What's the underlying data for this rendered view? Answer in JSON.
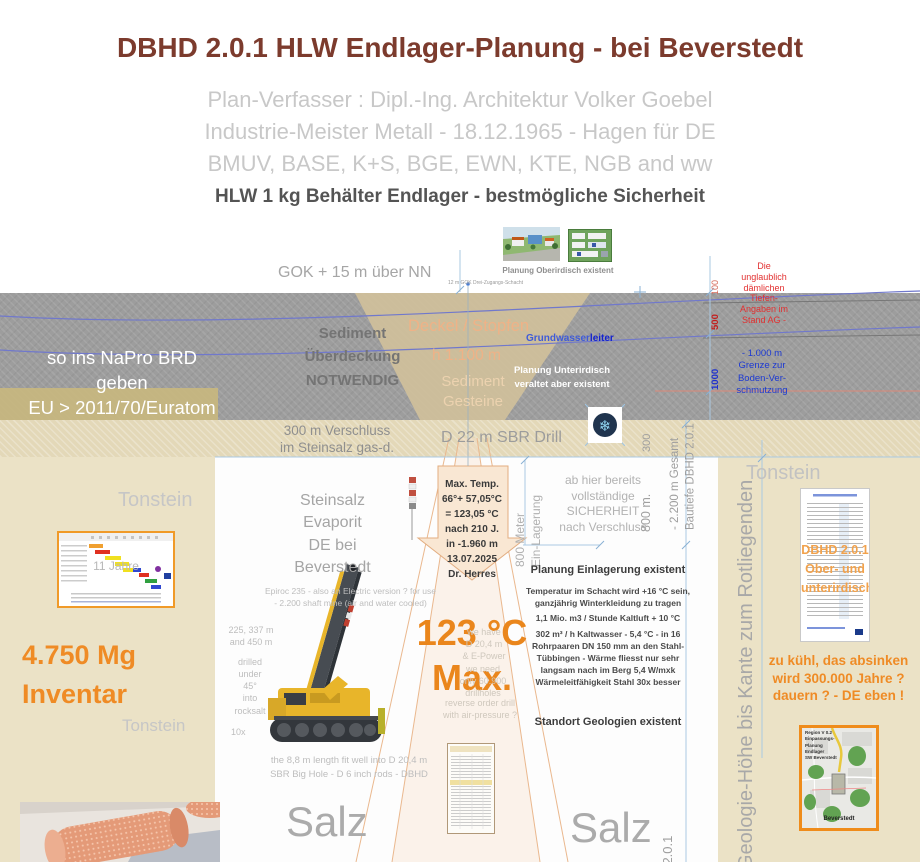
{
  "colors": {
    "title_maroon": "#7c3b2d",
    "accent_orange": "#ee8722",
    "light_orange": "#efb287",
    "band_gray": "#9d9d9d",
    "beige": "#ebe2c6",
    "strip_tan": "#e3d8b8",
    "warn_red": "#e23030",
    "depth_blue": "#1c39d2",
    "groundwater_blue": "#2f4fd0",
    "map_border_orange": "#ef8c1b"
  },
  "icons": {
    "snowflake": "❄"
  },
  "header": {
    "title": "DBHD 2.0.1 HLW Endlager-Planung - bei Beverstedt",
    "subtitle": "Plan-Verfasser :  Dipl.-Ing. Architektur Volker Goebel\nIndustrie-Meister Metall - 18.12.1965 - Hagen für DE\nBMUV, BASE, K+S, BGE, EWN, KTE, NGB and ww",
    "tagline": "HLW 1 kg Behälter Endlager - bestmögliche Sicherheit"
  },
  "surface": {
    "gok": "GOK + 15 m über NN",
    "shaft_note": "12 m GOK   Drei-Zugangs-Schacht",
    "plan_caption": "Planung Oberirdisch existent"
  },
  "band": {
    "napro": "so ins NaPro BRD geben\nEU > 2011/70/Euratom",
    "sediment": "Sediment\nÜberdeckung\nNOTWENDIG",
    "deckel": "Deckel / Stopfen",
    "h1100": "h 1.100 m",
    "gesteine": "Sediment\nGesteine",
    "gw_a": "Grundwasser",
    "gw_b": "leiter",
    "unterirdisch": "Planung Unterirdisch\nveraltet  aber existent"
  },
  "ruler": {
    "m100": "100",
    "m500": "500",
    "m1000": "1000",
    "red_note": "Die\nunglaublich\ndämlichen\nTiefen-\nAngaben im\nStand AG -",
    "blue_note": "- 1.000 m\nGrenze zur\nBoden-Ver-\nschmutzung"
  },
  "strip": {
    "verschluss": "300 m Verschluss\nim Steinsalz gas-d.",
    "drill": "D 22 m SBR Drill",
    "d300": "300"
  },
  "center": {
    "steinsalz": "Steinsalz\nEvaporit\nDE bei\nBeverstedt",
    "max_temp": "Max. Temp.\n66°+ 57,05°C\n= 123,05 °C\nnach 210 J.\nin -1.960 m\n13.07.2025\nDr. Herres",
    "einlagerung": "800 Meter\nEin-Lagerung",
    "sicherheit": "ab hier bereits\nvollständige\nSICHERHEIT\nnach Verschluss",
    "m800": "800 m.",
    "gesamt": "- 2.200 m Gesamt\nBautiefe DBHD 2.0.1",
    "plan_heading": "Planung Einlagerung existent",
    "plan_p1": "Temperatur im Schacht wird +16 °C sein,\nganzjährig Winterkleidung zu tragen",
    "plan_p2": "1,1 Mio. m3 / Stunde Kaltluft + 10 °C",
    "plan_p3": "302 m³ / h Kaltwasser - 5,4 °C - in 16\nRohrpaaren DN 150 mm an den Stahl-\nTübbingen - Wärme fliesst nur sehr\nlangsam nach im Berg 5,4 W/mxk\nWärmeleitfähigkeit Stahl 30x besser",
    "standort": "Standort Geologien existent",
    "temp123": "123 °C\nMax.",
    "salz_left": "Salz",
    "salz_right": "Salz",
    "dbhd_vertical": "DBHD 2.0.1"
  },
  "rig": {
    "epiroc": "Epiroc 235 - also an Electric version ? for use\n- 2.200 shaft mine (air and water cooled)",
    "depths": "225, 337 m\nand 450 m",
    "drilled": "drilled\nunder\n45°\ninto\nrocksalt",
    "tenx": "10x",
    "we_have": "we have\nD 20,4 m\n& E-Power",
    "we_need": "we need\nonly 60.900\ndrillholes",
    "reverse": "reverse order drill\nwith air-pressure ?",
    "fit": "the 8,8 m length fit well into D 20,4 m\nSBR Big Hole - D 6 inch rods - DBHD"
  },
  "left": {
    "tonstein_top": "Tonstein",
    "gantt_watermark": "11 Jahre",
    "inventar": "4.750 Mg\nInventar",
    "tonstein_bottom": "Tonstein"
  },
  "right": {
    "tonstein": "Tonstein",
    "geologie_vertical": "Geologie-Höhe bis Kante zum Rotliegenden",
    "doc_overlay": "DBHD 2.0.1\nOber- und\nunterirdisch",
    "kuehl": "zu kühl, das absinken\nwird 300.000 Jahre ?\ndauern ? - DE eben !",
    "map_top": "Region V 0.2\nEinpassungs-\nPlanung\nEndlager\nSW Beverstedt",
    "map_bottom": "Beverstedt"
  }
}
